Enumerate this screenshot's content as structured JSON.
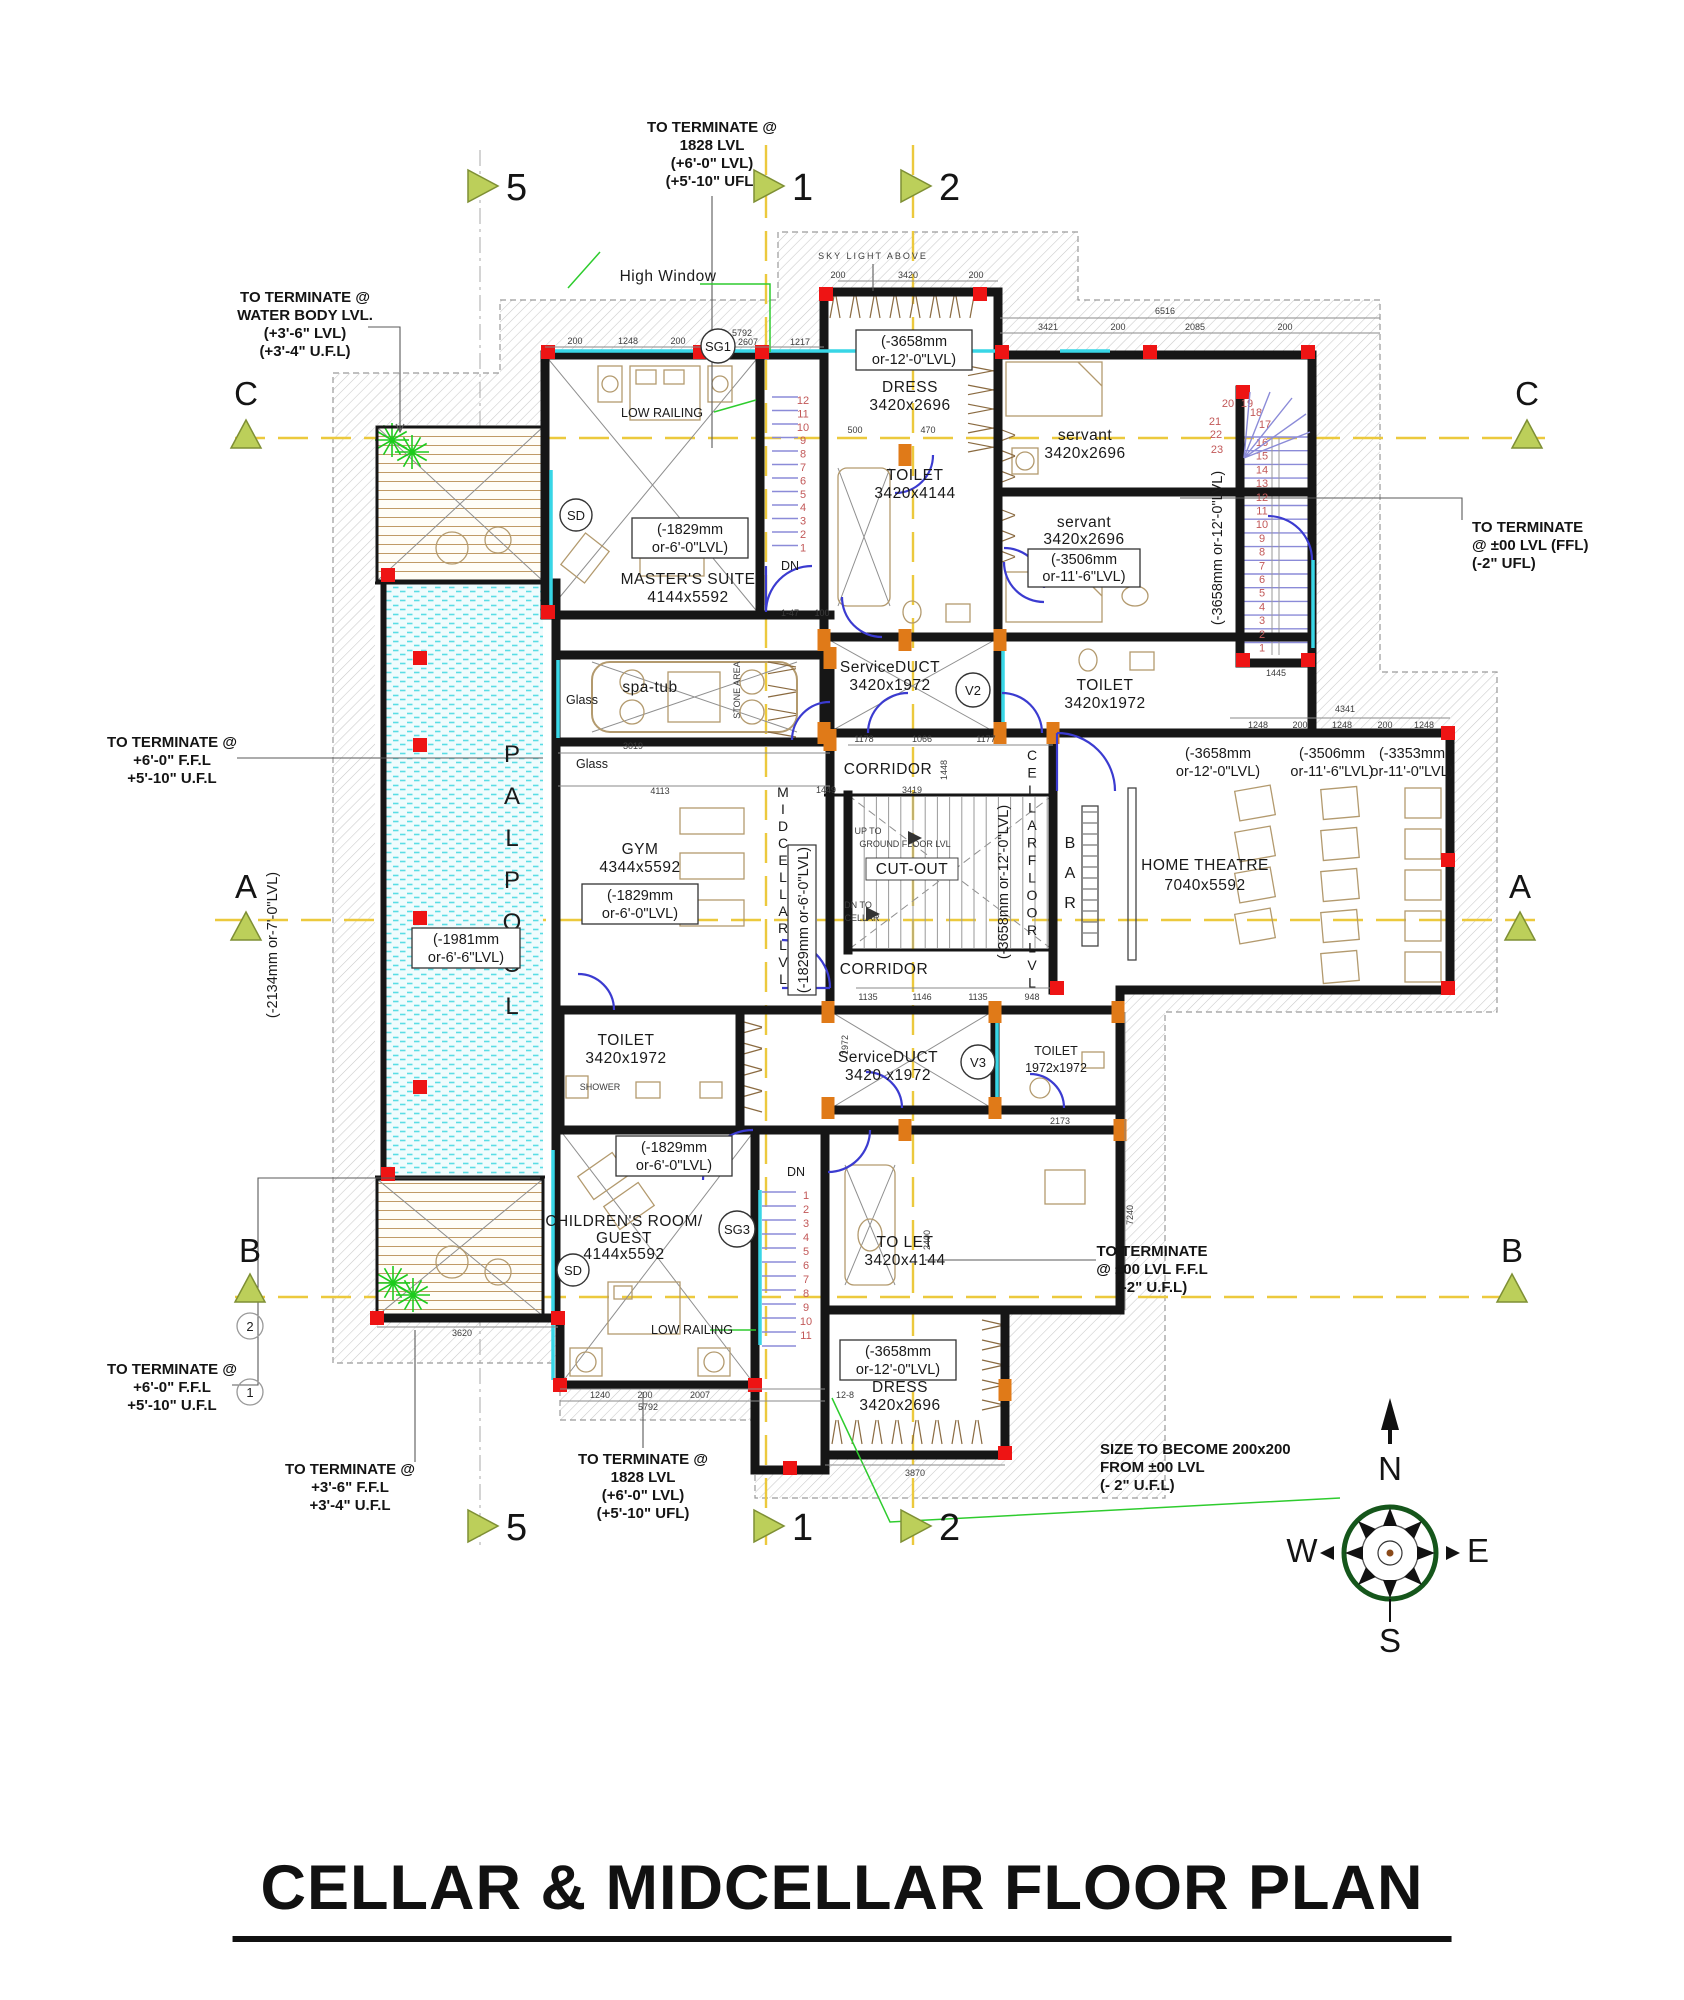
{
  "title": "CELLAR & MIDCELLAR FLOOR PLAN",
  "grid": {
    "cols": [
      "5",
      "1",
      "2"
    ],
    "rows": [
      "C",
      "A",
      "B"
    ],
    "circles": [
      "2",
      "1"
    ]
  },
  "compass": {
    "n": "N",
    "e": "E",
    "s": "S",
    "w": "W"
  },
  "annotations": {
    "water": [
      "TO TERMINATE @",
      "WATER BODY LVL.",
      "(+3'-6\" LVL)",
      "(+3'-4\" U.F.L)"
    ],
    "t1828": [
      "TO TERMINATE @",
      "1828 LVL",
      "(+6'-0\" LVL)",
      "(+5'-10\" UFL)"
    ],
    "right00": [
      "TO TERMINATE",
      "@ ±00 LVL (FFL)",
      "(-2\" UFL)"
    ],
    "t6ft": [
      "TO TERMINATE @",
      "+6'-0\" F.F.L",
      "+5'-10\" U.F.L"
    ],
    "t36": [
      "TO TERMINATE @",
      "+3'-6\" F.F.L",
      "+3'-4\" U.F.L"
    ],
    "rb00": [
      "TO TERMINATE",
      "@ ±00 LVL F.F.L",
      "(-2\" U.F.L)"
    ],
    "size": [
      "SIZE TO BECOME 200x200",
      "FROM ±00 LVL",
      "(- 2\" U.F.L)"
    ]
  },
  "rooms": {
    "master": {
      "name": [
        "MASTER'S SUITE",
        "4144x5592"
      ]
    },
    "dress_top": {
      "name": [
        "DRESS",
        "3420x2696"
      ]
    },
    "toilet_top": {
      "name": [
        "TOILET",
        "3420x4144"
      ]
    },
    "servant1": {
      "name": [
        "servant",
        "3420x2696"
      ]
    },
    "servant2": {
      "name": [
        "servant",
        "3420x2696"
      ]
    },
    "service_duct_top": {
      "name": [
        "ServiceDUCT",
        "3420x1972"
      ]
    },
    "toilet_mid": {
      "name": [
        "TOILET",
        "3420x1972"
      ]
    },
    "corridor_upper": {
      "name": "CORRIDOR"
    },
    "corridor_lower": {
      "name": "CORRIDOR"
    },
    "gym": {
      "name": [
        "GYM",
        "4344x5592"
      ]
    },
    "home_theatre": {
      "name": [
        "HOME THEATRE",
        "7040x5592"
      ]
    },
    "service_duct_bottom": {
      "name": [
        "ServiceDUCT",
        "3420 x1972"
      ]
    },
    "toilet_v3": {
      "name": [
        "TOILET",
        "1972x1972"
      ]
    },
    "toilet_bottom": {
      "name": [
        "TOILET",
        "3420x1972"
      ]
    },
    "toilet_guest": {
      "name": [
        "TO LET",
        "3420x4144"
      ]
    },
    "children": {
      "name": [
        "CHILDREN'S ROOM/",
        "GUEST",
        "4144x5592"
      ]
    },
    "dress_bottom": {
      "name": [
        "DRESS",
        "3420x2696"
      ]
    },
    "cut_out": {
      "name": "CUT-OUT"
    }
  },
  "levels": {
    "l1829": [
      "(-1829mm",
      "or-6'-0\"LVL)"
    ],
    "l1981": [
      "(-1981mm",
      "or-6'-6\"LVL)"
    ],
    "l3658": [
      "(-3658mm",
      "or-12'-0\"LVL)"
    ],
    "l3506": [
      "(-3506mm",
      "or-11'-6\"LVL)"
    ],
    "l3353": [
      "(-3353mm",
      "or-11'-0\"LVL)"
    ],
    "l2134_line": "(-2134mm or-7'-0\"LVL)",
    "l3658_line": "(-3658mm or-12'-0\"LVL)",
    "l1829_line": "(-1829mm or-6'-0\"LVL)"
  },
  "vertical_texts": {
    "pool": [
      "P",
      "A",
      "L",
      "P",
      "O",
      "O",
      "L"
    ],
    "bar": [
      "B",
      "A",
      "R"
    ],
    "cellar": [
      "C",
      "E",
      "L",
      "L",
      "A",
      "R",
      "F",
      "L",
      "O",
      "O",
      "R",
      "L",
      "V",
      "L"
    ],
    "midcellar": [
      "M",
      "I",
      "D",
      "C",
      "E",
      "L",
      "L",
      "A",
      "R",
      "L",
      "V",
      "L"
    ]
  },
  "stairs": {
    "right_run": [
      "16",
      "15",
      "14",
      "13",
      "12",
      "11",
      "10",
      "9",
      "8",
      "7",
      "6",
      "5",
      "4",
      "3",
      "2",
      "1"
    ],
    "winders": [
      "17",
      "18",
      "19",
      "20",
      "21",
      "22",
      "23"
    ],
    "upper_run": [
      "12",
      "11",
      "10",
      "9",
      "8",
      "7",
      "6",
      "5",
      "4",
      "3",
      "2",
      "1"
    ],
    "lower_run": [
      "1",
      "2",
      "3",
      "4",
      "5",
      "6",
      "7",
      "8",
      "9",
      "10",
      "11"
    ]
  },
  "misc": {
    "high_window": "High Window",
    "sky_light": "SKY LIGHT ABOVE",
    "low_railing": "LOW RAILING",
    "glass": "Glass",
    "spa_tub": "spa-tub",
    "shower": "SHOWER",
    "stone_area": "STONE AREA",
    "dn": "DN",
    "up_to": [
      "UP TO",
      "GROUND FLOOR LVL"
    ],
    "dn_to": [
      "DN TO",
      "CELLAR"
    ],
    "sg1": "SG1",
    "sd": "SD",
    "sg3": "SG3",
    "v2": "V2",
    "v3": "V3"
  },
  "dims": [
    "5792",
    "2607",
    "1217",
    "200",
    "1248",
    "3420",
    "6516",
    "3421",
    "2085",
    "1445",
    "3019",
    "4113",
    "1178",
    "1066",
    "1177",
    "3419",
    "1135",
    "1146",
    "948",
    "4341",
    "2173",
    "3870",
    "3620",
    "1240",
    "2007",
    "12-8",
    "1-47",
    "100",
    "1449",
    "500",
    "470",
    "7240",
    "1972",
    "2400",
    "1448"
  ]
}
